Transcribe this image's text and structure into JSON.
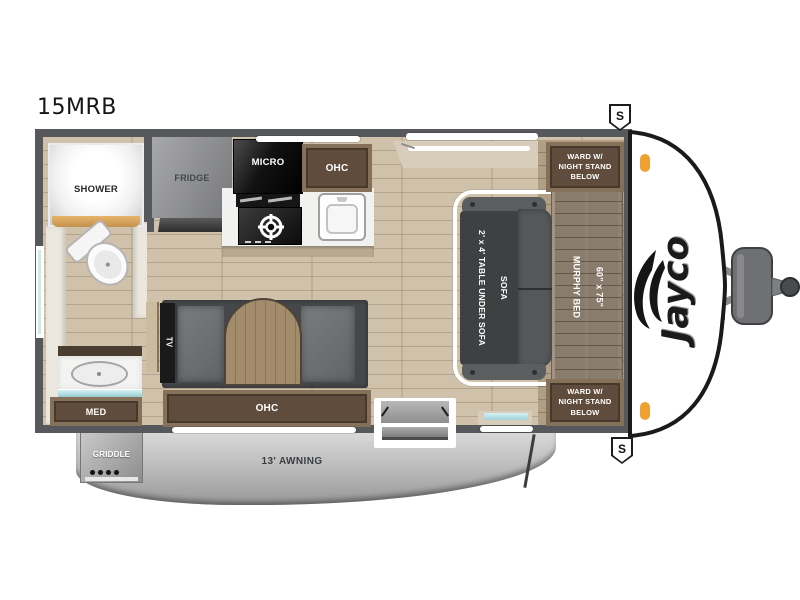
{
  "model": "15MRB",
  "brand": "Jayco",
  "badges": {
    "speaker_top": "S",
    "speaker_bottom": "S"
  },
  "exterior": {
    "awning": "13' AWNING",
    "griddle": "GRIDDLE"
  },
  "bathroom": {
    "shower": "SHOWER",
    "med": "MED"
  },
  "kitchen": {
    "fridge": "FRIDGE",
    "micro": "MICRO",
    "ohc": "OHC"
  },
  "bedroom": {
    "ward_top": "WARD W/\nNIGHT STAND\nBELOW",
    "ward_bottom": "WARD W/\nNIGHT STAND\nBELOW",
    "murphy_bed": "60\" x 75\"\nMURPHY BED",
    "sofa": "SOFA",
    "sofa_note": "2' x 4' TABLE UNDER SOFA"
  },
  "living": {
    "tv": "TV",
    "ohc": "OHC"
  },
  "colors": {
    "wall": "#57585b",
    "floor": "#cfc1aa",
    "cabinet": "#5f4c3c",
    "sofa": "#45474a",
    "murphy_bed": "#8a7c6d",
    "teal_accent": "#9fd3d8",
    "marker_light_orange": "#f0a030",
    "awning_gray": "#bcbcbc",
    "cap_white": "#ffffff"
  }
}
